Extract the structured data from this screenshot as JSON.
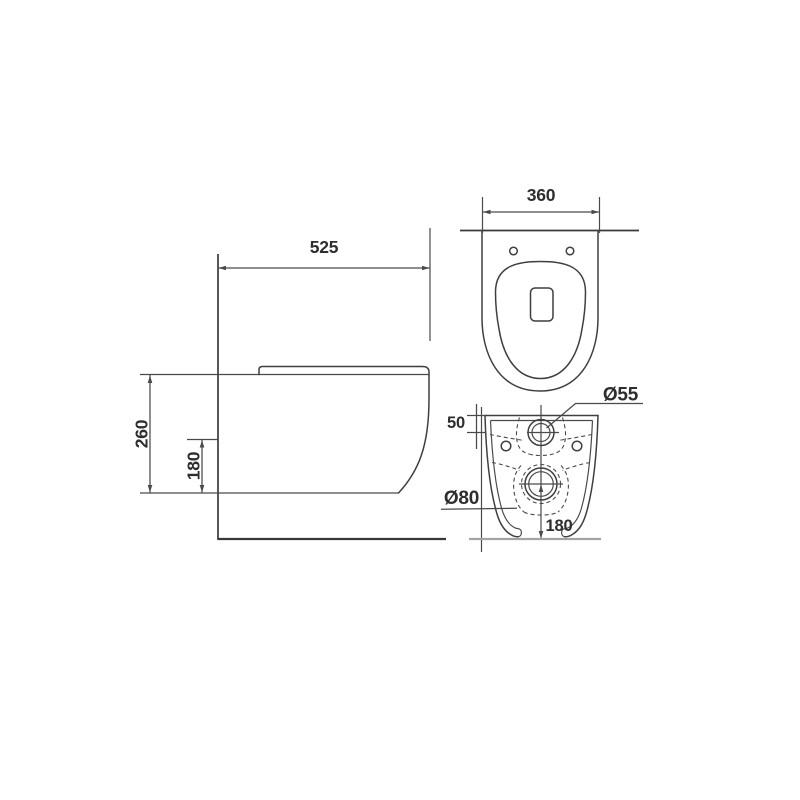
{
  "diagram": {
    "type": "technical-drawing",
    "subject": "wall-hung-toilet-three-views",
    "dims": {
      "side_depth": "525",
      "side_height": "260",
      "side_fixing_height": "180",
      "top_width": "360",
      "rear_inlet_offset": "50",
      "rear_inlet_diameter": "Ø55",
      "rear_outlet_diameter": "Ø80",
      "rear_outlet_center_height": "180"
    },
    "colors": {
      "line": "#3f3f3f",
      "light_line": "#a3a3a3",
      "background": "#ffffff"
    }
  }
}
